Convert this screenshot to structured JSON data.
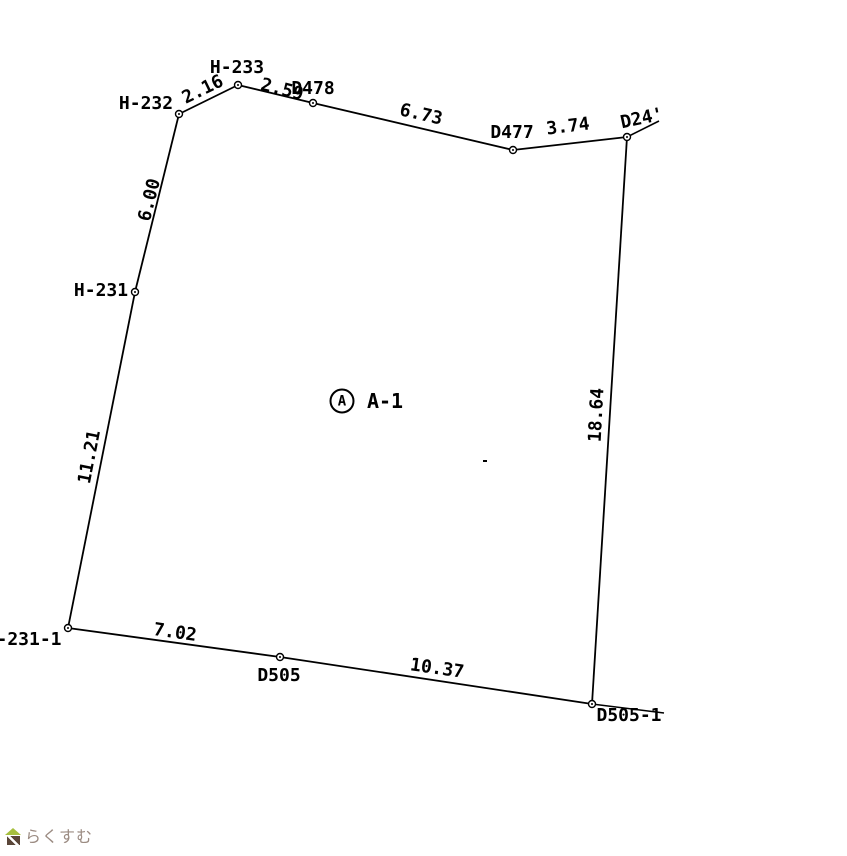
{
  "drawing": {
    "background_color": "#ffffff",
    "line_color": "#000000",
    "parcel": {
      "circle_letter": "A",
      "name": "A-1",
      "circle_cx": 342,
      "circle_cy": 401,
      "name_cx": 385,
      "name_cy": 401
    },
    "points": [
      {
        "id": "H-232",
        "x": 179,
        "y": 114
      },
      {
        "id": "H-233",
        "x": 238,
        "y": 85
      },
      {
        "id": "D478",
        "x": 313,
        "y": 103
      },
      {
        "id": "D477",
        "x": 513,
        "y": 150
      },
      {
        "id": "D24'",
        "x": 627,
        "y": 137
      },
      {
        "id": "D505-1",
        "x": 592,
        "y": 704
      },
      {
        "id": "D505",
        "x": 280,
        "y": 657
      },
      {
        "id": "-231-1",
        "x": 68,
        "y": 628
      },
      {
        "id": "H-231",
        "x": 135,
        "y": 292
      }
    ],
    "segments": [
      {
        "from": "H-232",
        "to": "H-233",
        "distance": "2.16"
      },
      {
        "from": "H-233",
        "to": "D478",
        "distance": "2.59"
      },
      {
        "from": "D478",
        "to": "D477",
        "distance": "6.73"
      },
      {
        "from": "D477",
        "to": "D24'",
        "distance": "3.74"
      },
      {
        "from": "D24'",
        "to": "D505-1",
        "distance": "18.64"
      },
      {
        "from": "D505-1",
        "to": "D505",
        "distance": "10.37"
      },
      {
        "from": "D505",
        "to": "-231-1",
        "distance": "7.02"
      },
      {
        "from": "-231-1",
        "to": "H-231",
        "distance": "11.21"
      },
      {
        "from": "H-231",
        "to": "H-232",
        "distance": "6.00"
      }
    ],
    "extension_lines": [
      {
        "x1": 627,
        "y1": 137,
        "x2": 659,
        "y2": 121
      },
      {
        "x1": 592,
        "y1": 704,
        "x2": 664,
        "y2": 713
      }
    ],
    "labels": [
      {
        "text": "H-233",
        "cx": 237,
        "cy": 68,
        "rot": 0,
        "kind": "point"
      },
      {
        "text": "H-232",
        "cx": 146,
        "cy": 104,
        "rot": 0,
        "kind": "point"
      },
      {
        "text": "2.16",
        "cx": 203,
        "cy": 90,
        "rot": -26,
        "kind": "distance"
      },
      {
        "text": "2.59",
        "cx": 282,
        "cy": 90,
        "rot": 14,
        "kind": "distance"
      },
      {
        "text": "D478",
        "cx": 313,
        "cy": 89,
        "rot": 0,
        "kind": "point"
      },
      {
        "text": "6.73",
        "cx": 421,
        "cy": 115,
        "rot": 13,
        "kind": "distance"
      },
      {
        "text": "D477",
        "cx": 512,
        "cy": 133,
        "rot": 0,
        "kind": "point"
      },
      {
        "text": "3.74",
        "cx": 568,
        "cy": 127,
        "rot": -7,
        "kind": "distance"
      },
      {
        "text": "D24'",
        "cx": 642,
        "cy": 119,
        "rot": -12,
        "kind": "point"
      },
      {
        "text": "6.00",
        "cx": 150,
        "cy": 200,
        "rot": -76,
        "kind": "distance"
      },
      {
        "text": "H-231",
        "cx": 101,
        "cy": 291,
        "rot": 0,
        "kind": "point"
      },
      {
        "text": "11.21",
        "cx": 90,
        "cy": 457,
        "rot": -79,
        "kind": "distance"
      },
      {
        "text": "18.64",
        "cx": 597,
        "cy": 415,
        "rot": -87,
        "kind": "distance"
      },
      {
        "text": "-231-1",
        "cx": 29,
        "cy": 640,
        "rot": 0,
        "kind": "point"
      },
      {
        "text": "7.02",
        "cx": 175,
        "cy": 633,
        "rot": 8,
        "kind": "distance"
      },
      {
        "text": "D505",
        "cx": 279,
        "cy": 676,
        "rot": 0,
        "kind": "point"
      },
      {
        "text": "10.37",
        "cx": 437,
        "cy": 669,
        "rot": 8,
        "kind": "distance"
      },
      {
        "text": "D505-1",
        "cx": 629,
        "cy": 716,
        "rot": 0,
        "kind": "point"
      }
    ],
    "stray_dot": {
      "x": 483,
      "y": 460
    }
  },
  "watermark": {
    "text": "らくすむ",
    "text_color": "#9b8b82",
    "house_roof_color": "#a6bf3e",
    "house_body_color": "#5a4639"
  }
}
